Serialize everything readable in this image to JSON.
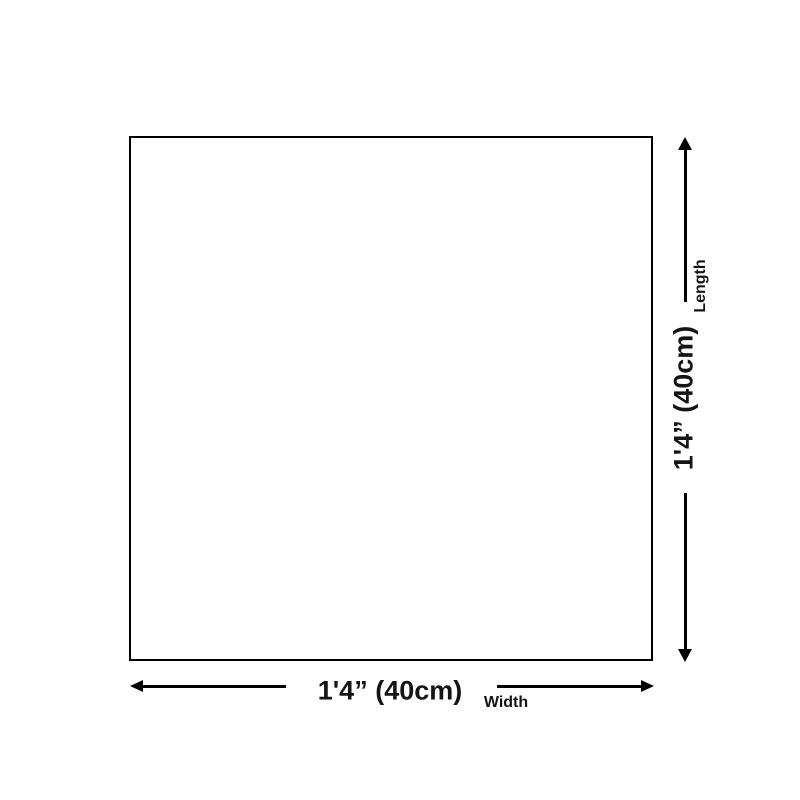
{
  "page": {
    "background": "#ffffff"
  },
  "diagram": {
    "type": "product-dimension-diagram",
    "shape": {
      "kind": "square-outline",
      "fill": "#ffffff",
      "border_color": "#000000"
    },
    "length": {
      "value": "1'4” (40cm)",
      "label": "Length"
    },
    "width": {
      "value": "1'4” (40cm)",
      "label": "Width"
    },
    "icons": {
      "up": "arrow-up-icon (css triangle)",
      "down": "arrow-down-icon (css triangle)",
      "left": "arrow-left-icon (css triangle)",
      "right": "arrow-right-icon (css triangle)"
    },
    "colors": {
      "line": "#000000",
      "text": "#141414",
      "background": "#ffffff"
    }
  }
}
